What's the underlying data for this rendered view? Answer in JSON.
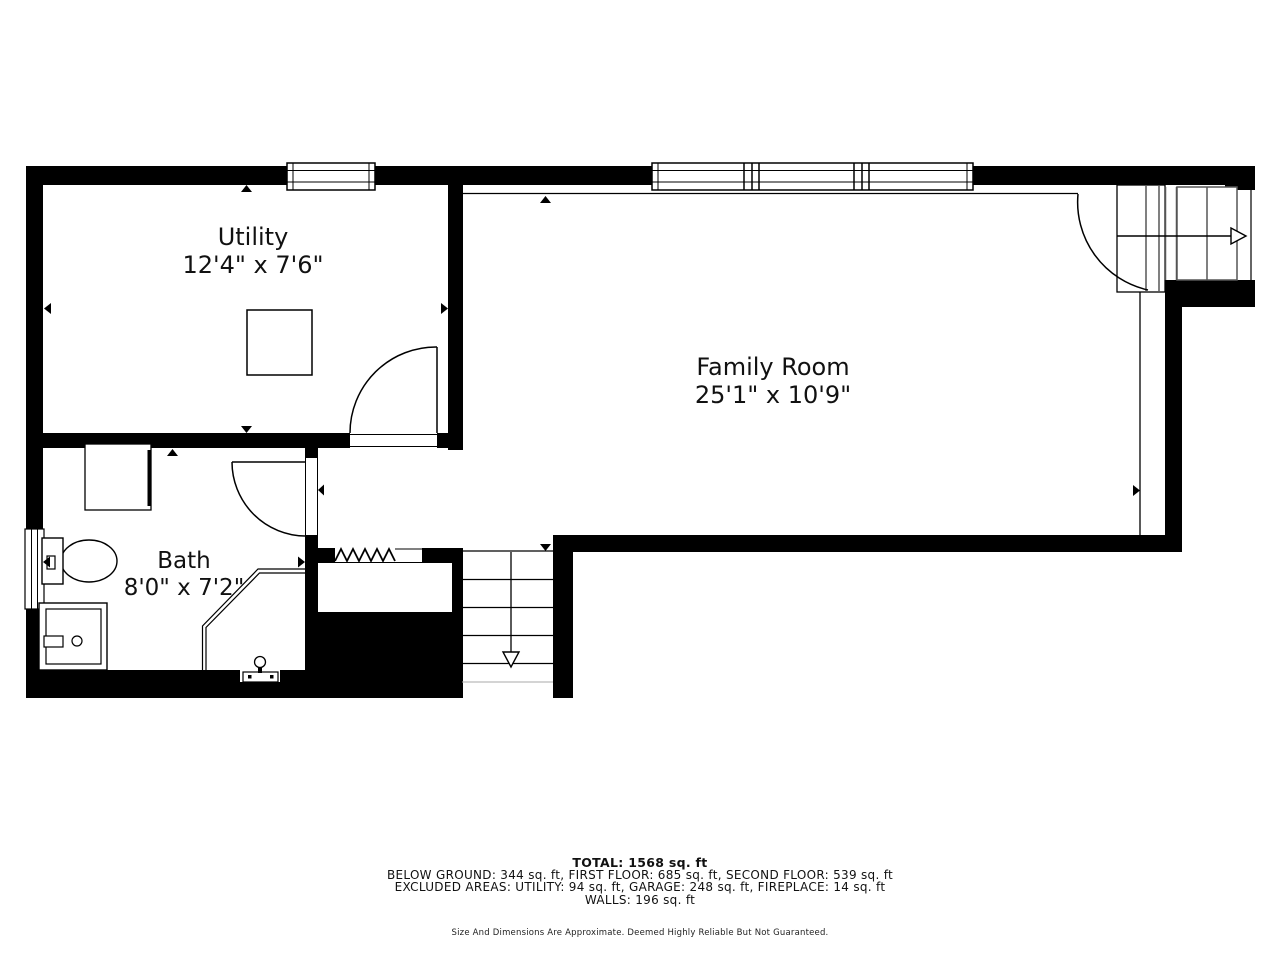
{
  "plan": {
    "type": "floor-plan",
    "floor": "below-ground",
    "rooms": [
      {
        "id": "utility",
        "name": "Utility",
        "dimensions": "12'4\" x 7'6\""
      },
      {
        "id": "family_room",
        "name": "Family Room",
        "dimensions": "25'1\" x 10'9\""
      },
      {
        "id": "bath",
        "name": "Bath",
        "dimensions": "8'0\" x 7'2\""
      }
    ],
    "features": [
      "stairs-up-arrow",
      "stairs-down-arrow",
      "windows",
      "doors",
      "toilet",
      "shower",
      "furnace-box",
      "corner-shower",
      "fireplace-mass"
    ]
  },
  "summary": {
    "total": "TOTAL: 1568 sq. ft",
    "floors": "BELOW GROUND: 344 sq. ft, FIRST FLOOR: 685 sq. ft, SECOND FLOOR: 539 sq. ft",
    "excluded": "EXCLUDED AREAS: UTILITY: 94 sq. ft, GARAGE: 248 sq. ft, FIREPLACE: 14 sq. ft",
    "walls": "WALLS: 196 sq. ft",
    "disclaimer": "Size And Dimensions Are Approximate. Deemed Highly Reliable But Not Guaranteed."
  },
  "colors": {
    "wall": "#000000",
    "background": "#ffffff",
    "tread": "#555555"
  }
}
